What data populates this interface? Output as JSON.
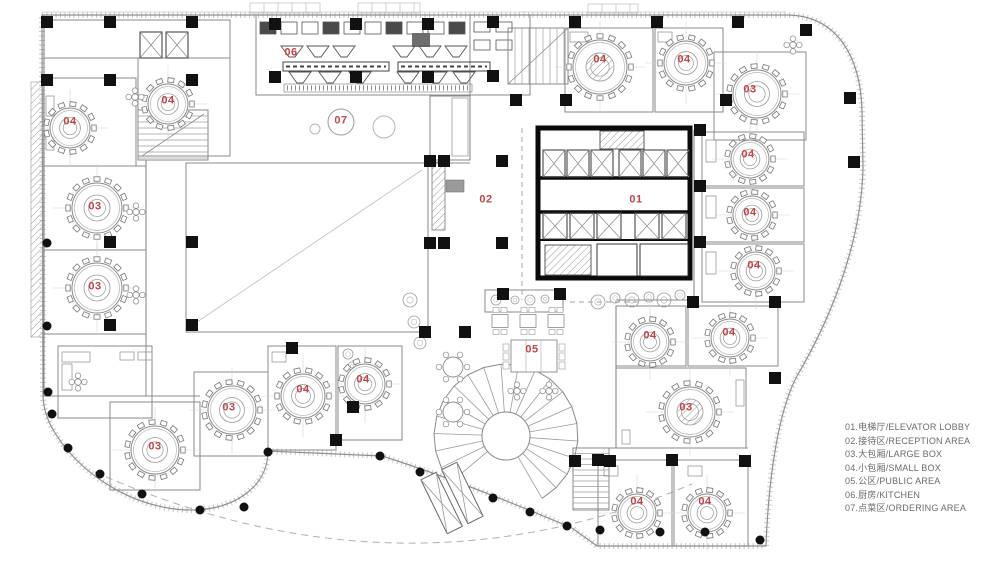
{
  "title": "Restaurant floor plan with room legend",
  "colors": {
    "label_red": "#c04448",
    "legend_text": "#6a6a6a",
    "line_light": "#b9b9b9",
    "line_mid": "#8a8a8a",
    "line_dark": "#555555",
    "black": "#111111"
  },
  "legend": {
    "items": [
      {
        "code": "01",
        "zh": "电梯厅",
        "en": "ELEVATOR LOBBY",
        "display": "01.电梯厅/ELEVATOR LOBBY"
      },
      {
        "code": "02",
        "zh": "接待区",
        "en": "RECEPTION AREA",
        "display": "02.接待区/RECEPTION AREA"
      },
      {
        "code": "03",
        "zh": "大包厢",
        "en": "LARGE BOX",
        "display": "03.大包厢/LARGE BOX"
      },
      {
        "code": "04",
        "zh": "小包厢",
        "en": "SMALL BOX",
        "display": "04.小包厢/SMALL BOX"
      },
      {
        "code": "05",
        "zh": "公区",
        "en": "PUBLIC AREA",
        "display": "05.公区/PUBLIC AREA"
      },
      {
        "code": "06",
        "zh": "厨房",
        "en": "KITCHEN",
        "display": "06.厨房/KITCHEN"
      },
      {
        "code": "07",
        "zh": "点菜区",
        "en": "ORDERING AREA",
        "display": "07.点菜区/ORDERING AREA"
      }
    ]
  },
  "room_labels": [
    {
      "text": "04",
      "x": 70,
      "y": 122
    },
    {
      "text": "04",
      "x": 168,
      "y": 101
    },
    {
      "text": "06",
      "x": 291,
      "y": 53
    },
    {
      "text": "07",
      "x": 341,
      "y": 121
    },
    {
      "text": "02",
      "x": 486,
      "y": 200
    },
    {
      "text": "01",
      "x": 636,
      "y": 200
    },
    {
      "text": "04",
      "x": 600,
      "y": 60
    },
    {
      "text": "04",
      "x": 684,
      "y": 60
    },
    {
      "text": "03",
      "x": 750,
      "y": 90
    },
    {
      "text": "04",
      "x": 748,
      "y": 155
    },
    {
      "text": "04",
      "x": 750,
      "y": 213
    },
    {
      "text": "04",
      "x": 754,
      "y": 266
    },
    {
      "text": "03",
      "x": 95,
      "y": 207
    },
    {
      "text": "03",
      "x": 95,
      "y": 287
    },
    {
      "text": "04",
      "x": 650,
      "y": 336
    },
    {
      "text": "04",
      "x": 729,
      "y": 333
    },
    {
      "text": "05",
      "x": 532,
      "y": 350
    },
    {
      "text": "03",
      "x": 686,
      "y": 408
    },
    {
      "text": "04",
      "x": 303,
      "y": 390
    },
    {
      "text": "04",
      "x": 363,
      "y": 380
    },
    {
      "text": "03",
      "x": 229,
      "y": 408
    },
    {
      "text": "03",
      "x": 155,
      "y": 447
    },
    {
      "text": "04",
      "x": 637,
      "y": 502
    },
    {
      "text": "04",
      "x": 705,
      "y": 502
    }
  ]
}
